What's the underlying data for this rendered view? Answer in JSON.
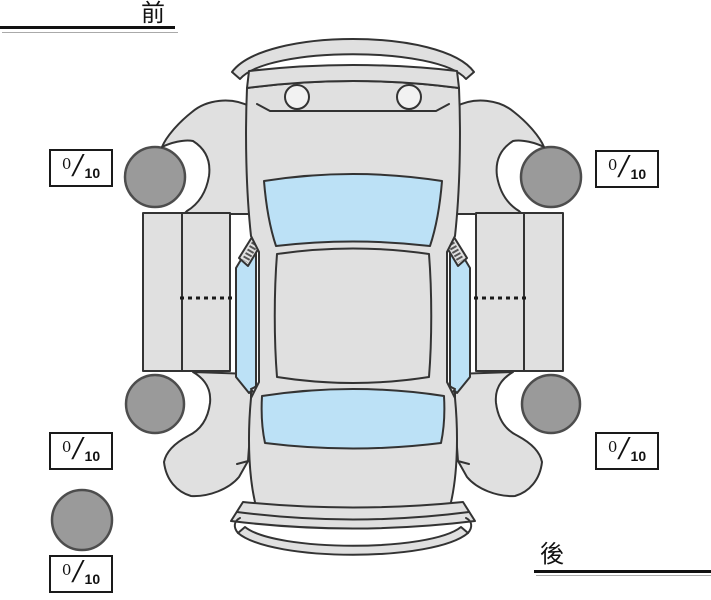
{
  "orientation_labels": {
    "front": "前",
    "rear": "後"
  },
  "rating_format": {
    "separator": "/"
  },
  "ratings": {
    "front_left": {
      "value": "0",
      "max": "10"
    },
    "front_right": {
      "value": "0",
      "max": "10"
    },
    "rear_left": {
      "value": "0",
      "max": "10"
    },
    "rear_right": {
      "value": "0",
      "max": "10"
    },
    "spare": {
      "value": "0",
      "max": "10"
    }
  },
  "colors": {
    "background": "#ffffff",
    "car_body": "#e0e0e0",
    "glass": "#bce1f6",
    "tire": "#9a9a9a",
    "tire_outline": "#4d4d4d",
    "outline": "#333333"
  }
}
